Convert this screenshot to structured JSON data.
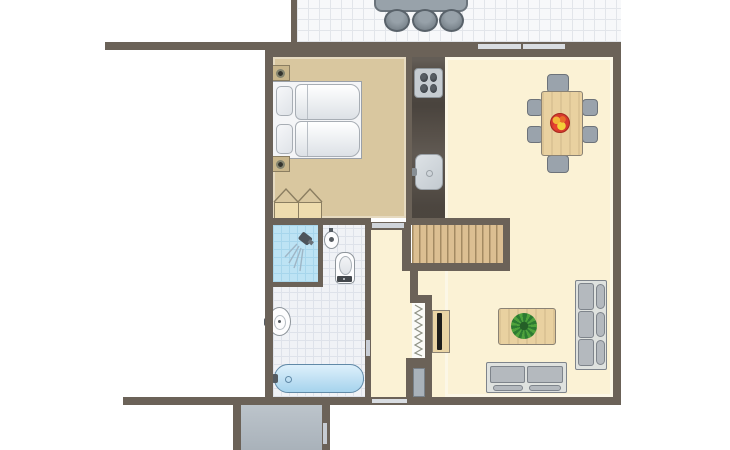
{
  "meta": {
    "title": "Holiday home apartment floor plan",
    "view": "top-down architectural illustration",
    "visible_text": "none"
  },
  "areas": {
    "terrace": {
      "name": "Tiled terrace (outside, top edge, partially cut off)",
      "items": [
        "outdoor dining table (top of image, cut off)",
        "3 round-backed outdoor chairs"
      ]
    },
    "bedroom": {
      "name": "Bedroom (tan floor, top left)",
      "items": [
        "double bed (2 mattresses, 2 pillows)",
        "2 bedside tables with lamps",
        "wardrobe with open door swing lines"
      ]
    },
    "kitchen": {
      "name": "Kitchen counter strip (dark worktop)",
      "items": [
        "cooktop with 4 burners",
        "kitchen sink with tap"
      ]
    },
    "living_dining": {
      "name": "Living / dining room (cream floor, right)",
      "items": [
        "dining table with fruit bowl",
        "6 gray dining chairs",
        "wooden staircase with treads",
        "TV cabinet with flat TV",
        "coffee table with green plant",
        "3-seat sofa along right wall",
        "2-seat sofa along bottom wall"
      ]
    },
    "bathroom": {
      "name": "Bathroom (white tiles, middle left)",
      "items": [
        "blue shower cabin with shower head spray",
        "small hand basin",
        "toilet with cistern",
        "wall-mounted washbasin",
        "bathtub with tap"
      ]
    },
    "hallway": {
      "name": "Hallway (cream floor, middle)",
      "items": [
        "radiator (zig-zag symbol)",
        "front door at bottom"
      ]
    },
    "storage": {
      "name": "Storage room / shed (outside, bottom, cut off)",
      "items": [
        "door in right wall"
      ]
    }
  },
  "counts": {
    "dining_chairs": 6,
    "cooktop_burners": 4,
    "sofa_seats_large": 3,
    "sofa_seats_small": 2,
    "bed_pillows": 2,
    "bedside_tables": 2,
    "outdoor_chairs_visible": 3,
    "stair_treads_approx": 13,
    "top_wall_window_segments": 2
  },
  "openings": {
    "windows": [
      "two window segments in top wall of living room",
      "window in bottom wall of hallway"
    ],
    "doors": [
      "bedroom door at top of hallway",
      "bathroom door from hallway",
      "front door at bottom of hallway recess",
      "storage room door in right wall"
    ]
  },
  "colors": {
    "wall": "#6b6258",
    "bedroom-floor": "#d9c79f",
    "living-floor": "#fbf2d5",
    "tile-bg": "#f0f2f6",
    "tile-line": "#dee2ea",
    "terrace-bg": "#f7f8fa",
    "terrace-line": "#e2e5ea",
    "shower-bg": "#bde3f4",
    "shower-line": "#a7d6ec",
    "counter": "#564f48",
    "wood": "#e9d1a0",
    "wood-border": "#8a8274",
    "stairs-bg": "#dcbf92",
    "stairs-line": "#a38a62",
    "chair": "#9aa3ac",
    "chair-border": "#6d737a",
    "sofa-frame": "#dfe2df",
    "sofa-cushion": "#b4b9be",
    "sofa-border": "#7e848b",
    "fixture-border": "#8e959b",
    "metal": "#545b62",
    "tub-hi": "#ddf0fb",
    "tub-lo": "#a6d3ed",
    "tub-border": "#6089a7",
    "door": "#a9b2ba",
    "window": "#d9dde2",
    "storage-hi": "#bcc4cb",
    "storage-lo": "#a9b2ba",
    "plant-dark": "#2c7a31",
    "plant-light": "#4ea23c",
    "bowl": "#d63a2e",
    "bowl-border": "#a8281e",
    "lamp-ring": "#84846f",
    "lamp-core": "#32322c",
    "mattress-border": "#a7adb4",
    "outdoor-table": "#98a2aa",
    "outdoor-border": "#6b747c",
    "outdoor-chair": "#7b858d",
    "radiator-line": "#8f9285",
    "nightstand": "#c9b68b",
    "nightstand-border": "#8b7e61"
  }
}
